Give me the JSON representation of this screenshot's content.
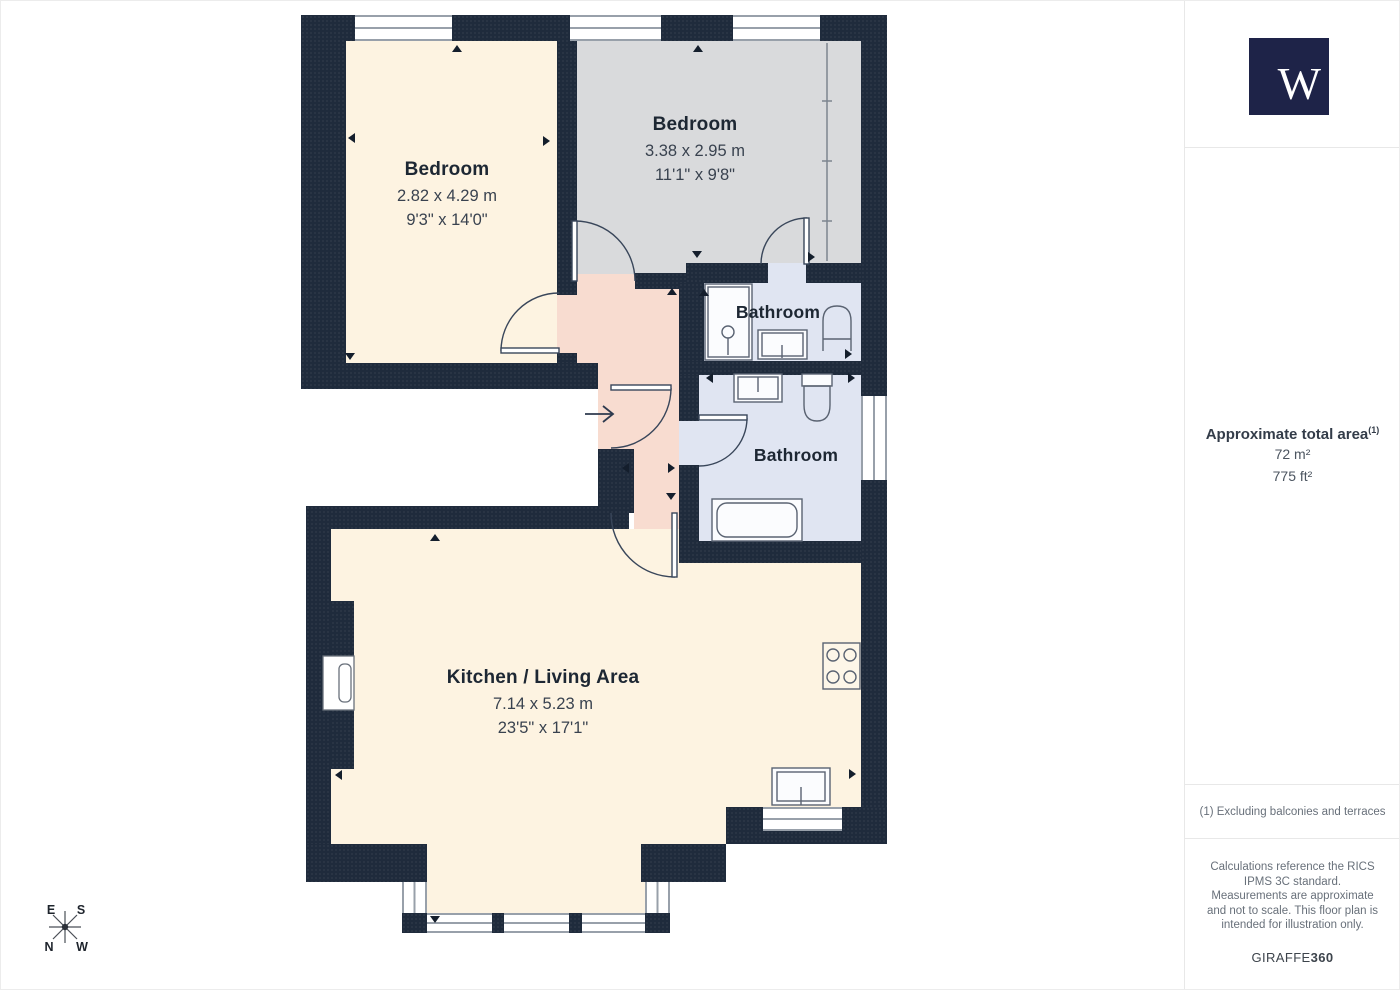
{
  "plan": {
    "rooms": [
      {
        "name": "Bedroom",
        "dim_metric": "2.82 x 4.29 m",
        "dim_imperial": "9'3\" x 14'0\""
      },
      {
        "name": "Bedroom",
        "dim_metric": "3.38 x 2.95 m",
        "dim_imperial": "11'1\" x 9'8\""
      },
      {
        "name": "Bathroom"
      },
      {
        "name": "Bathroom"
      },
      {
        "name": "Kitchen / Living Area",
        "dim_metric": "7.14 x 5.23 m",
        "dim_imperial": "23'5\" x 17'1\""
      }
    ],
    "compass": {
      "east": "E",
      "south": "S",
      "north": "N",
      "west": "W"
    }
  },
  "sidebar": {
    "logo_letter": "W",
    "area": {
      "title": "Approximate total area",
      "superscript": "(1)",
      "metric": "72 m²",
      "imperial": "775 ft²"
    },
    "footnote": "(1) Excluding balconies and terraces",
    "disclaimer": "Calculations reference the RICS IPMS 3C standard. Measurements are approximate and not to scale. This floor plan is intended for illustration only.",
    "brand": {
      "regular": "GIRAFFE",
      "bold": "360"
    }
  },
  "colors": {
    "wall": "#1f2b3c",
    "bedroom_fill": "#fdf3e1",
    "gray_bedroom_fill": "#d9dadc",
    "bathroom_fill": "#e0e5f2",
    "hall_fill": "#f8dcd0",
    "logo_background": "#1e2348"
  }
}
